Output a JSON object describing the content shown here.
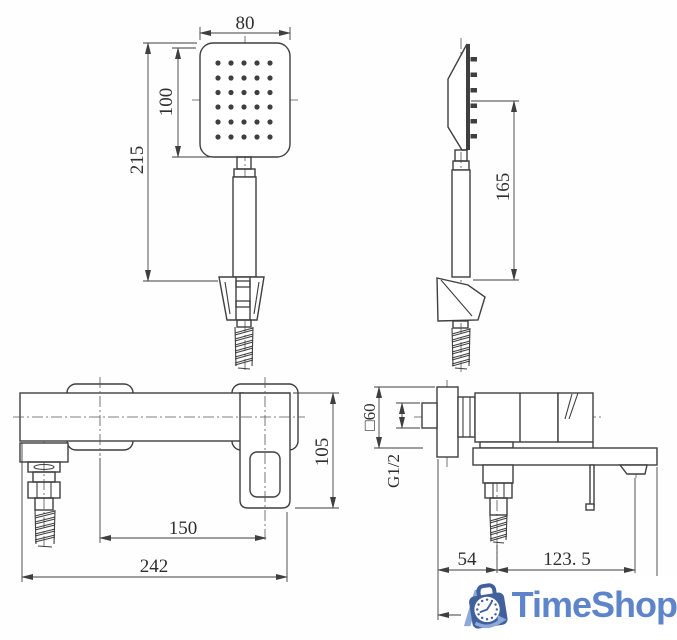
{
  "drawing": {
    "line_color": "#3f3f3f",
    "views": {
      "shower_front": {
        "name": "hand shower front view",
        "dims": {
          "width": "80",
          "head_height": "100",
          "total_height": "215"
        }
      },
      "shower_side": {
        "name": "hand shower side view",
        "dims": {
          "holder_height": "165"
        }
      },
      "mixer_front": {
        "name": "mixer front view",
        "dims": {
          "body_height": "105",
          "hole_distance": "150",
          "total_width": "242"
        }
      },
      "mixer_side": {
        "name": "mixer side view",
        "dims": {
          "escutcheon_size": "□60",
          "thread_size": "G1/2",
          "wall_to_hose": "54",
          "hose_to_spout": "123. 5"
        }
      }
    }
  },
  "logo": {
    "text": "TimeShop",
    "bag_color": "#40609e",
    "accent_color": "#8da9d9",
    "text_color": "#5e84c9"
  }
}
